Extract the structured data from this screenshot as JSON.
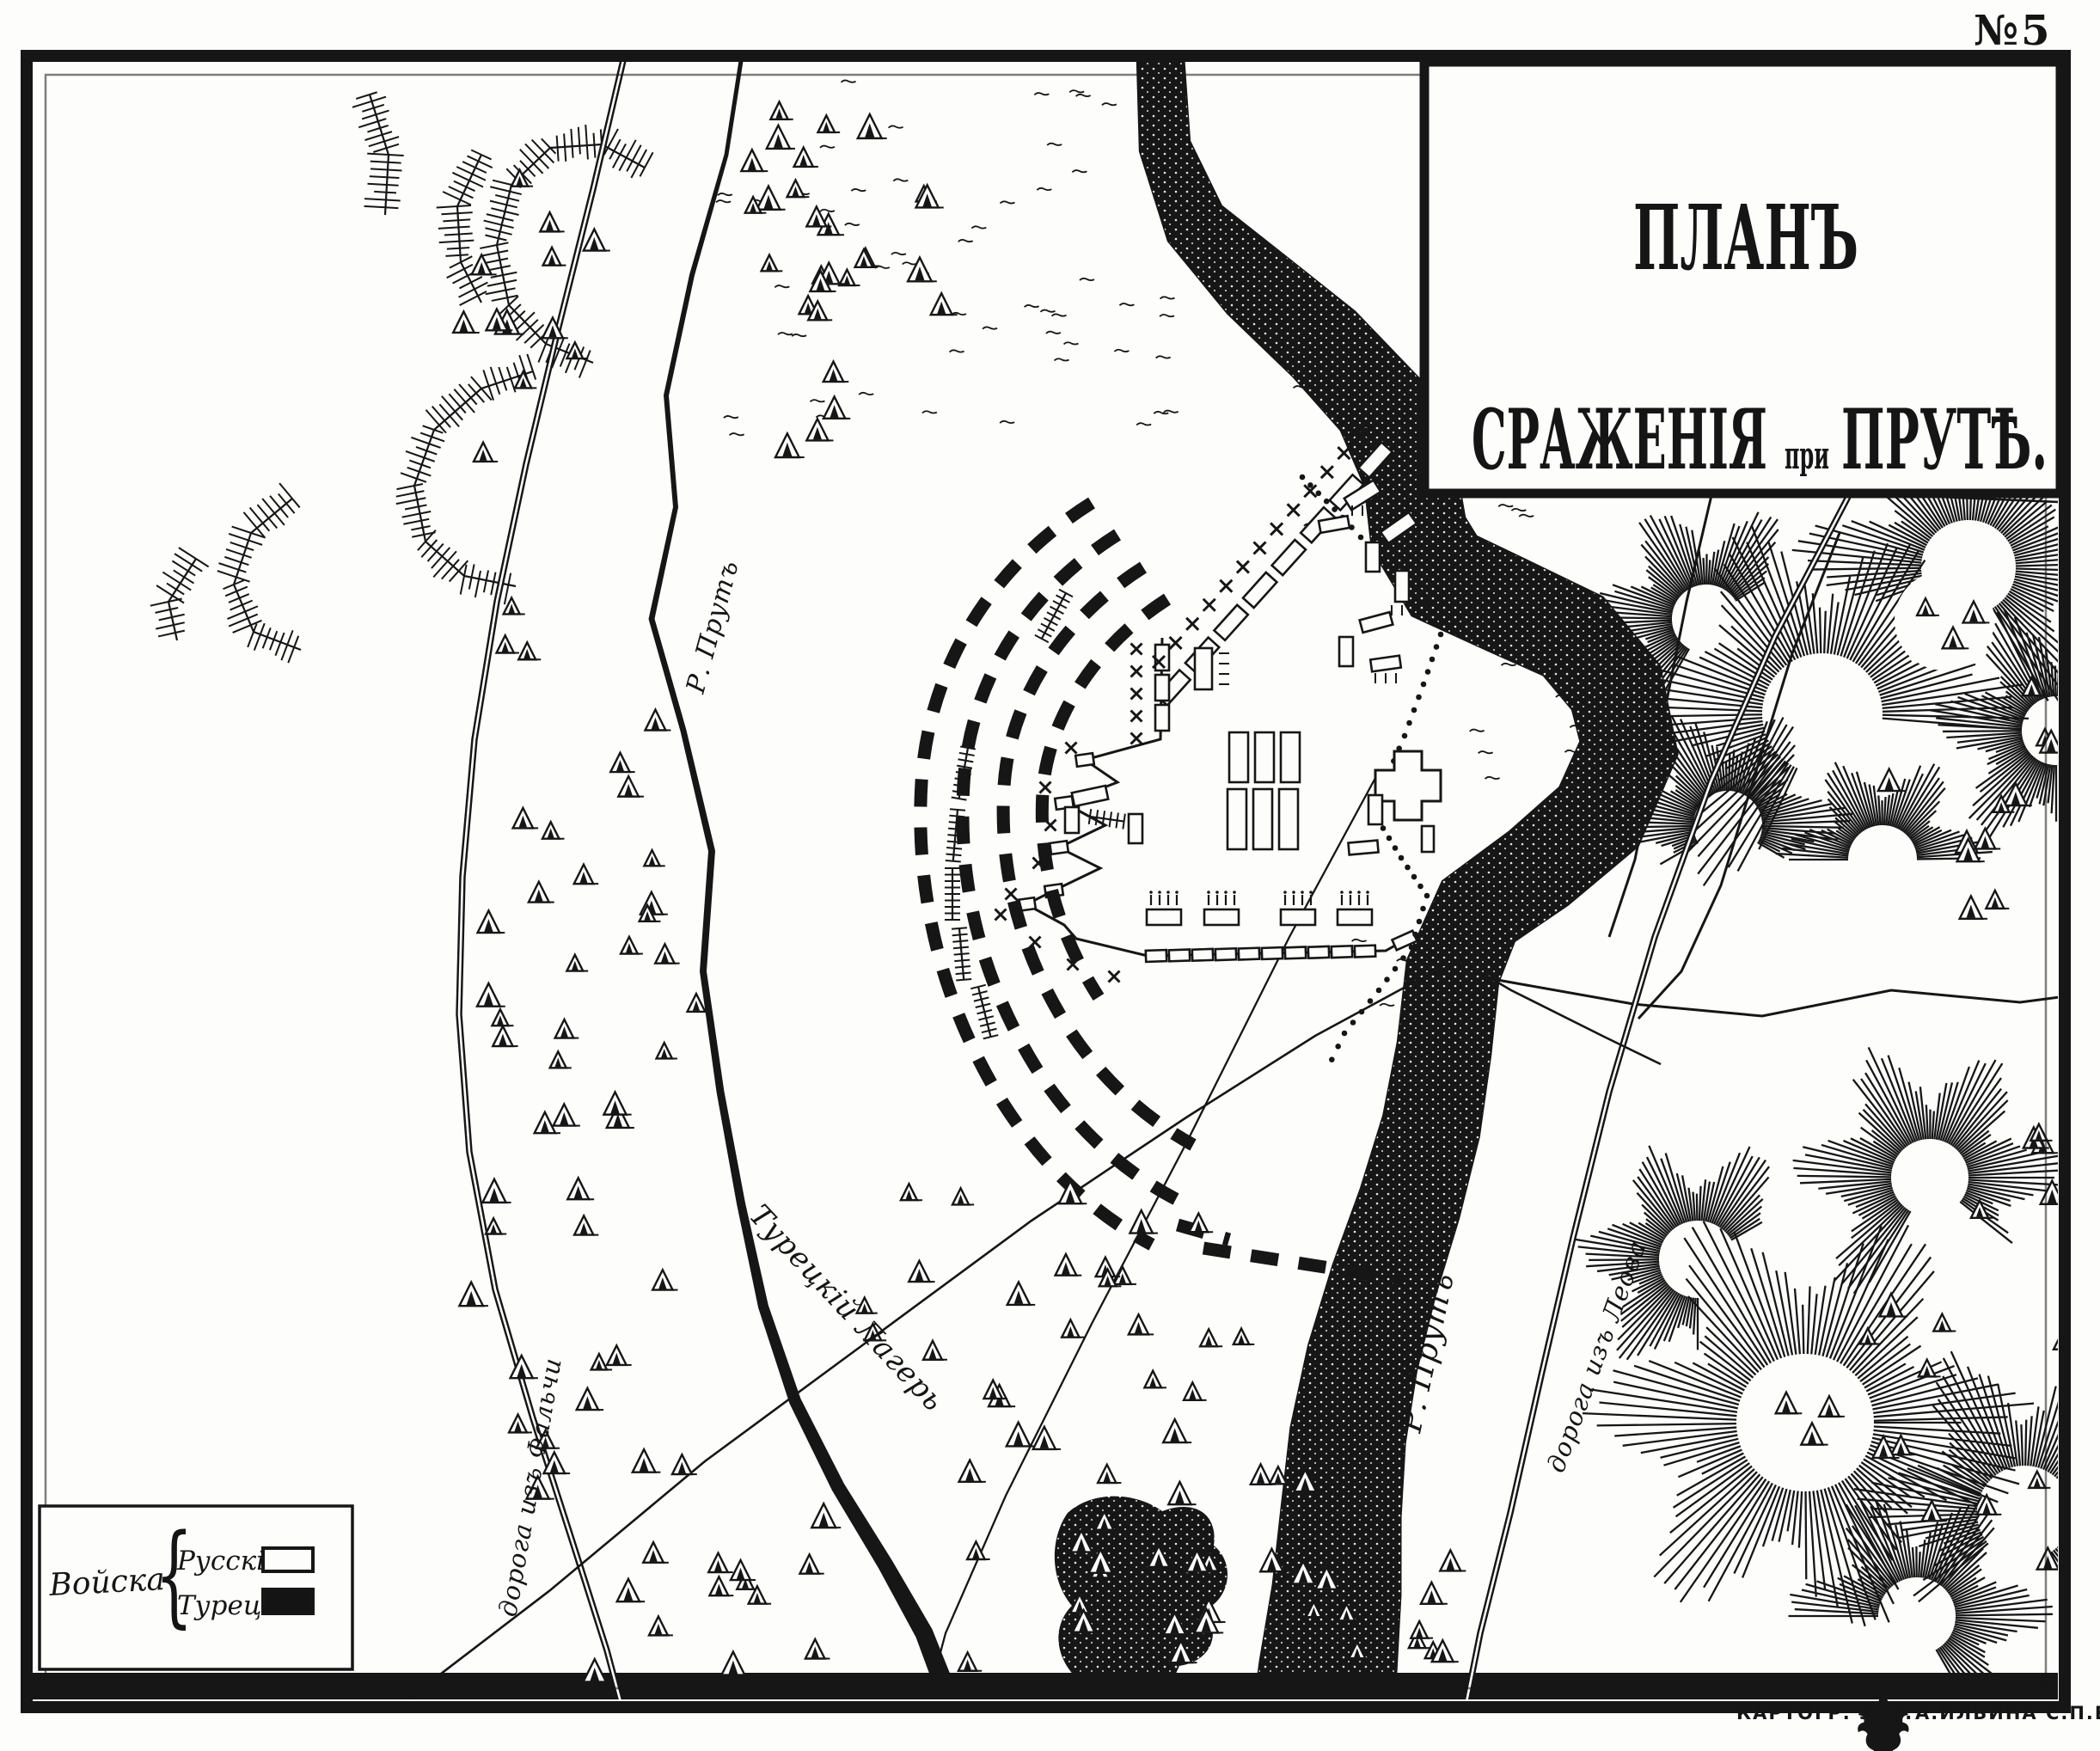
{
  "page": {
    "number": "№5"
  },
  "title": {
    "line1": "ПЛАНЪ",
    "line2_word1": "СРАЖЕНІЯ",
    "line2_word2": "при",
    "line2_word3": "ПРУТѢ."
  },
  "legend": {
    "heading": "Войска",
    "brace": "{",
    "items": [
      {
        "label": "Русскія",
        "swatch_color": "#fdfdfc"
      },
      {
        "label": "Турецк.",
        "swatch_color": "#141414"
      }
    ]
  },
  "map_labels": {
    "river_left": "Р. Прутъ",
    "river_right": "Р. Прутъ",
    "turkish_camp": "Турецкій Лагерь",
    "road_left": "дорога изъ Фальчи",
    "road_right": "дорога изъ Леова"
  },
  "imprint": {
    "part1": "КАРТОГР. ЗАВ.",
    "part2": "А.ИЛЬИНА С.П.Б."
  },
  "colors": {
    "ink": "#161616",
    "paper": "#fdfdfc"
  }
}
